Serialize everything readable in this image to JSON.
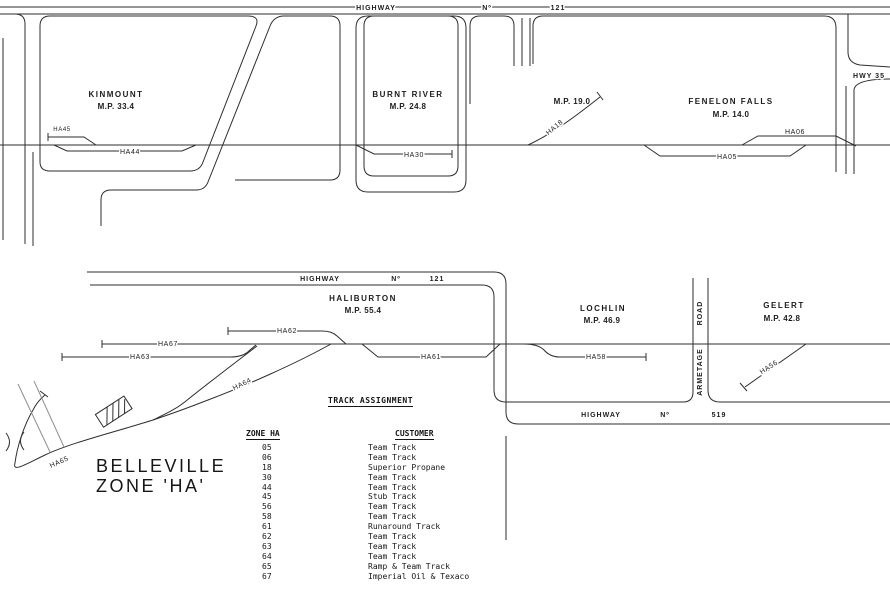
{
  "title": {
    "line1": "BELLEVILLE",
    "line2": "ZONE 'HA'"
  },
  "roads": {
    "highway121_top": {
      "word1": "HIGHWAY",
      "word2": "Nº",
      "word3": "121"
    },
    "highway121_bottom": {
      "word1": "HIGHWAY",
      "word2": "Nº",
      "word3": "121"
    },
    "highway519": {
      "word1": "HIGHWAY",
      "word2": "Nº",
      "word3": "519"
    },
    "hwy35": "HWY 35",
    "armetage": {
      "word1": "ARMETAGE",
      "word2": "ROAD"
    }
  },
  "stations": {
    "kinmount": {
      "name": "KINMOUNT",
      "mp": "M.P. 33.4"
    },
    "burnt_river": {
      "name": "BURNT RIVER",
      "mp": "M.P. 24.8"
    },
    "ha18_site": {
      "mp": "M.P. 19.0"
    },
    "fenelon_falls": {
      "name": "FENELON FALLS",
      "mp": "M.P. 14.0"
    },
    "haliburton": {
      "name": "HALIBURTON",
      "mp": "M.P. 55.4"
    },
    "lochlin": {
      "name": "LOCHLIN",
      "mp": "M.P. 46.9"
    },
    "gelert": {
      "name": "GELERT",
      "mp": "M.P. 42.8"
    }
  },
  "tracks": {
    "ha45": "HA45",
    "ha44": "HA44",
    "ha30": "HA30",
    "ha18": "HA18",
    "ha05": "HA05",
    "ha06": "HA06",
    "ha62": "HA62",
    "ha67": "HA67",
    "ha63": "HA63",
    "ha61": "HA61",
    "ha64": "HA64",
    "ha65": "HA65",
    "ha58": "HA58",
    "ha56": "HA56"
  },
  "table": {
    "title": "TRACK ASSIGNMENT",
    "col_zone": "ZONE HA",
    "col_customer": "CUSTOMER",
    "rows": [
      {
        "zone": "05",
        "customer": "Team Track"
      },
      {
        "zone": "06",
        "customer": "Team Track"
      },
      {
        "zone": "18",
        "customer": "Superior Propane"
      },
      {
        "zone": "30",
        "customer": "Team Track"
      },
      {
        "zone": "44",
        "customer": "Team Track"
      },
      {
        "zone": "45",
        "customer": "Stub Track"
      },
      {
        "zone": "56",
        "customer": "Team Track"
      },
      {
        "zone": "58",
        "customer": "Team Track"
      },
      {
        "zone": "61",
        "customer": "Runaround Track"
      },
      {
        "zone": "62",
        "customer": "Team Track"
      },
      {
        "zone": "63",
        "customer": "Team Track"
      },
      {
        "zone": "64",
        "customer": "Team Track"
      },
      {
        "zone": "65",
        "customer": "Ramp & Team Track"
      },
      {
        "zone": "67",
        "customer": "Imperial Oil & Texaco"
      }
    ]
  }
}
